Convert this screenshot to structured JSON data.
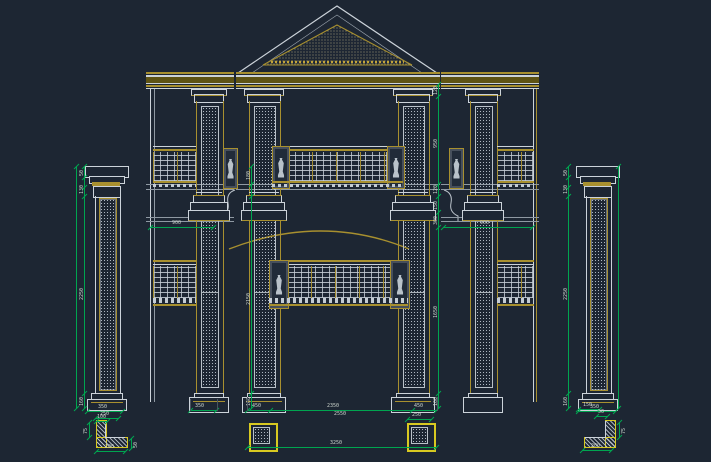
{
  "canvas": {
    "background": "#1d2633"
  },
  "colors": {
    "line_white": "#ccd3da",
    "gold": "#a8902f",
    "gold_band": "#5e5314",
    "bright_yellow": "#d8c921",
    "dimension_green": "#00a550",
    "label_text": "#cdd5cd"
  },
  "dims": {
    "col": {
      "cap_a": "50",
      "cap_b": "130",
      "shaft": "2250",
      "base": "160",
      "base_w": "350",
      "shaft_w": "250"
    },
    "center_left": {
      "top": "180",
      "mid": "2150",
      "base": "160"
    },
    "center_right": {
      "top": "120",
      "upper": "950",
      "band_a": "120",
      "band_b": "150",
      "band_c": "300",
      "lower": "1650",
      "base": "160"
    },
    "wing": {
      "width": "900"
    },
    "bottom": {
      "wing_plinth": "350",
      "seg_left": "450",
      "span_a": "2350",
      "span_b": "2550",
      "seg_right": "450",
      "total": "3250",
      "square": "250"
    },
    "corner": {
      "top": "100",
      "top_r": "150",
      "small": "50",
      "side": "75",
      "bottom": "200"
    }
  }
}
